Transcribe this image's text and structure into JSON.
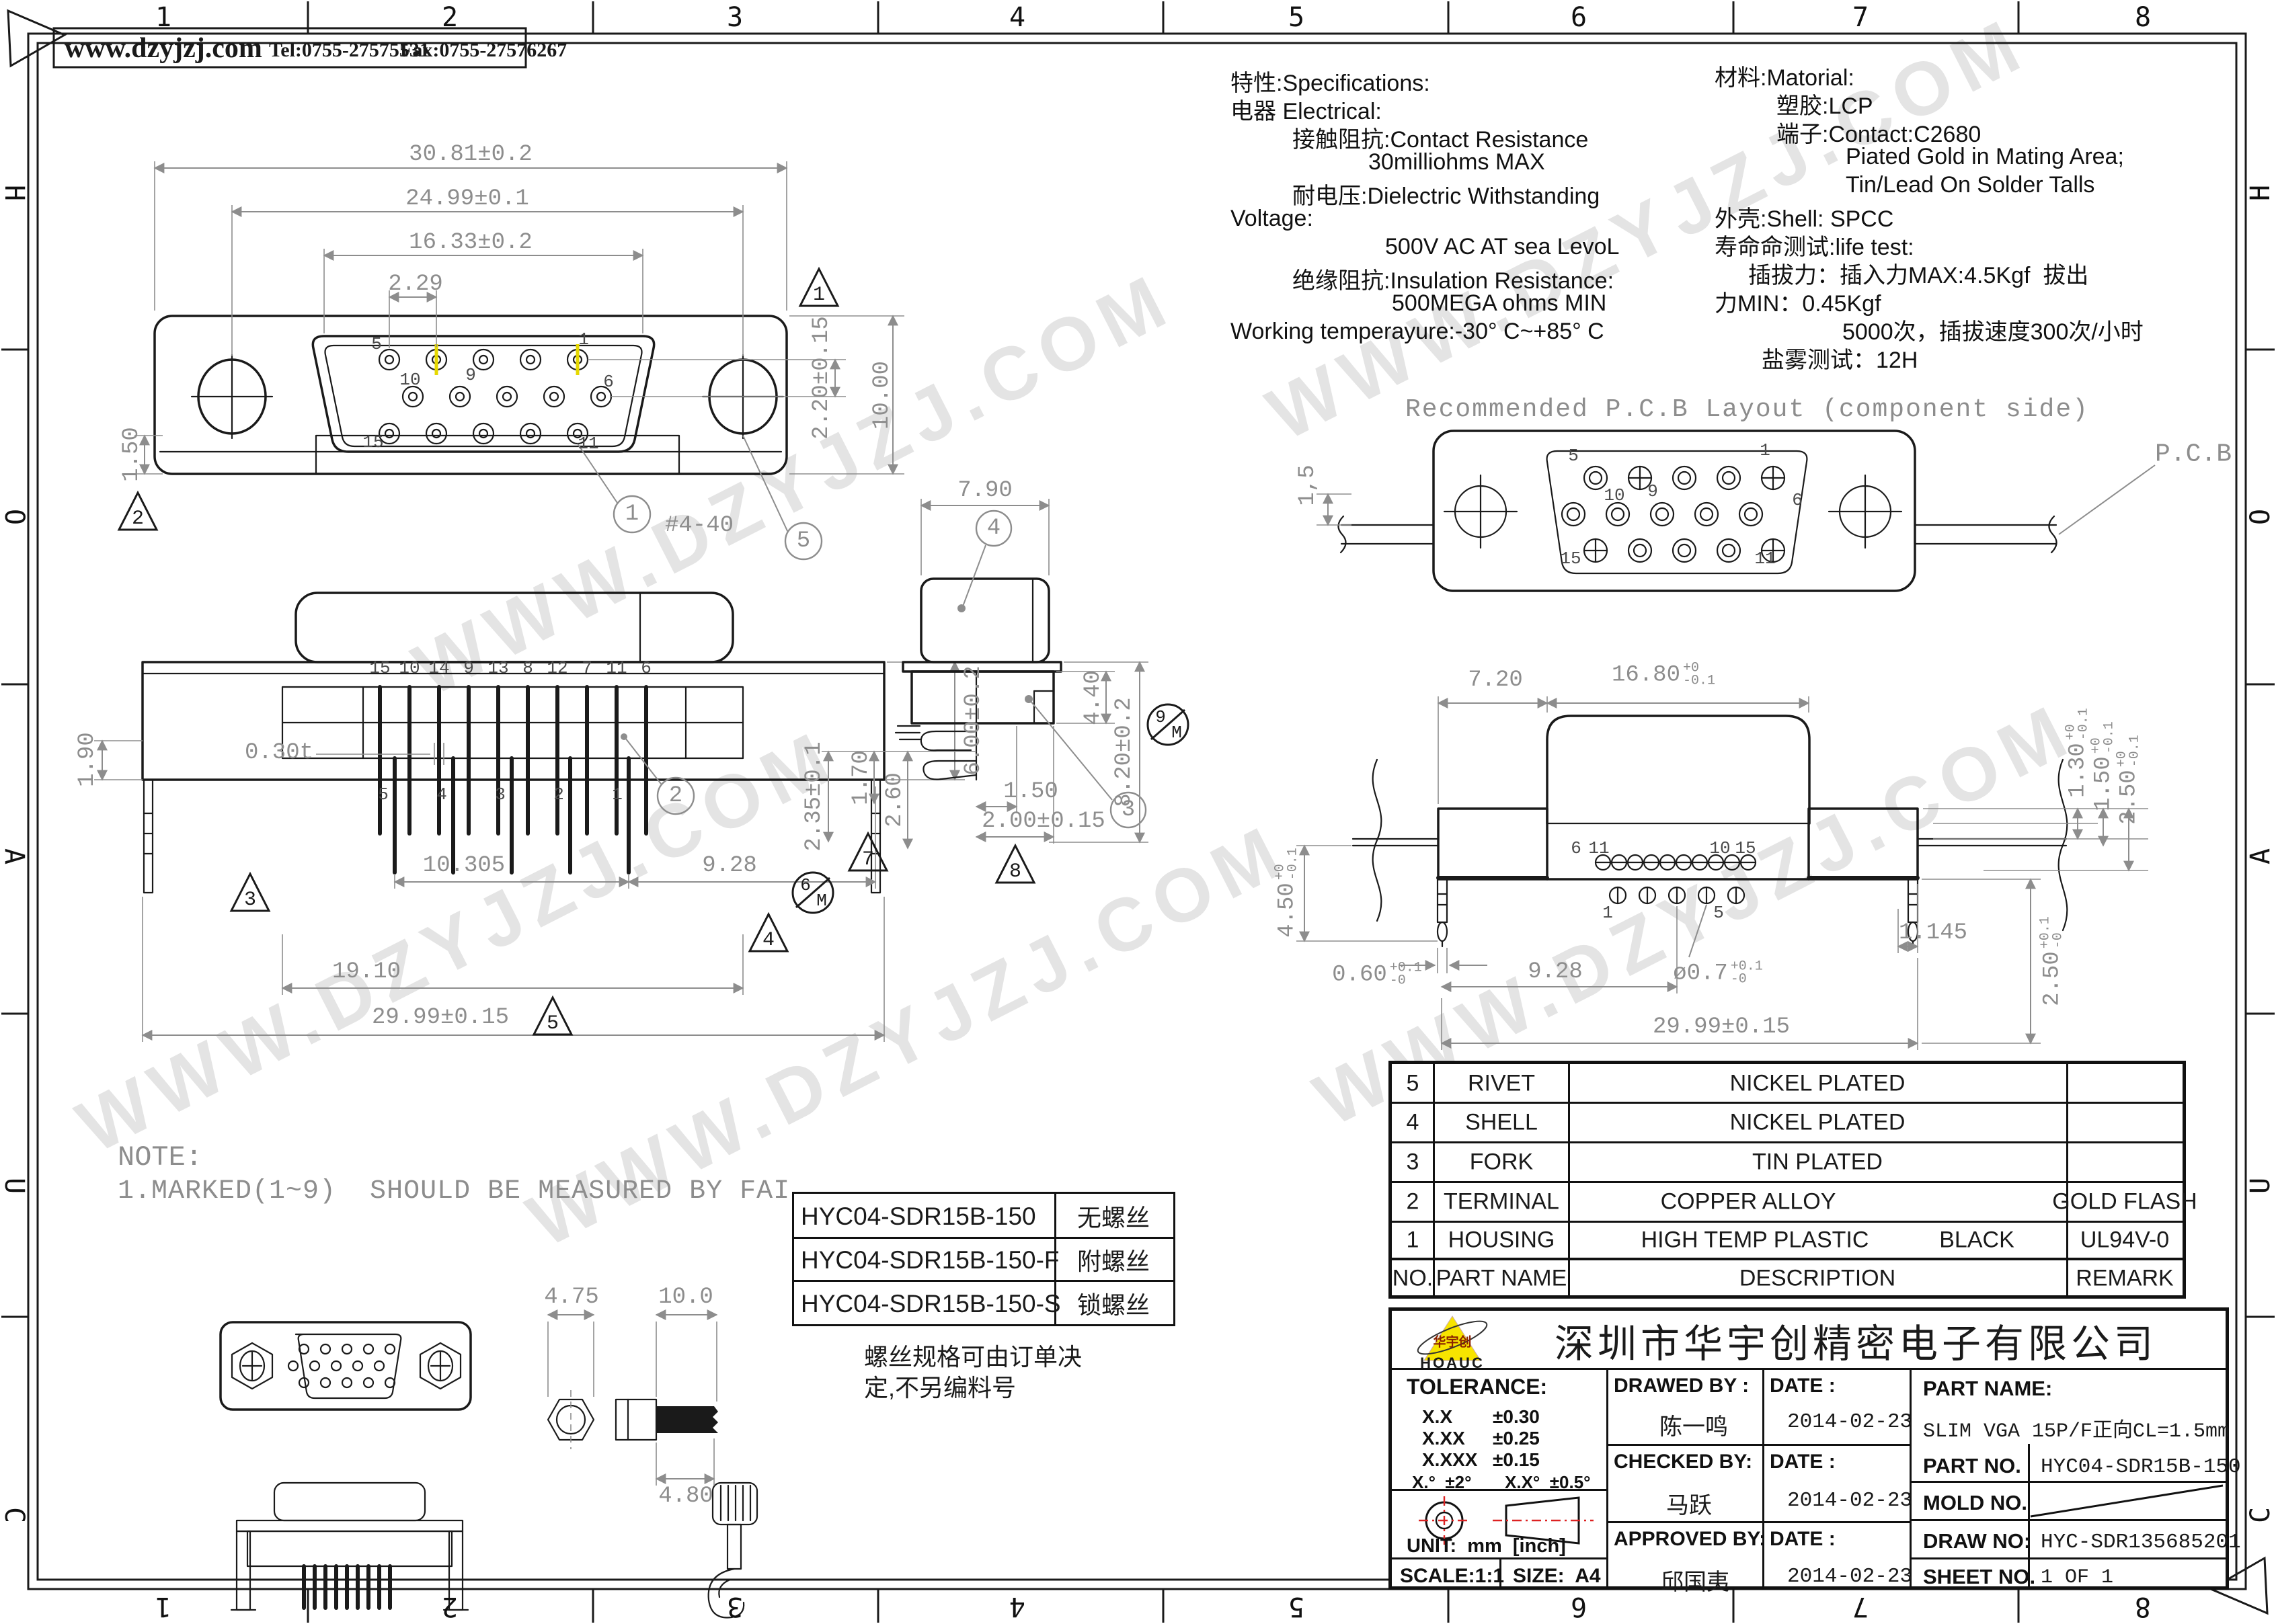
{
  "frame": {
    "cols": [
      "1",
      "2",
      "3",
      "4",
      "5",
      "6",
      "7",
      "8"
    ],
    "rows": [
      "H",
      "O",
      "A",
      "U",
      "C"
    ]
  },
  "header": {
    "website": "www.dzyjzj.com",
    "tel": "Tel:0755-27575531",
    "fax": "Fax:0755-27576267"
  },
  "watermark": "WWW.DZYJZJ.COM",
  "specs": [
    "特性:Specifications:",
    "电器 Electrical:",
    "接触阻抗:Contact Resistance",
    "30milliohms MAX",
    "耐电压:Dielectric Withstanding",
    "Voltage:",
    "500V AC AT sea LevoL",
    "绝缘阻抗:Insulation Resistance:",
    "500MEGA ohms MIN",
    "Working temperayure:-30° C~+85° C"
  ],
  "materials": [
    "材料:Matorial:",
    "塑胶:LCP",
    "端子:Contact:C2680",
    "Piated Gold in Mating Area;",
    "Tin/Lead On Solder Talls",
    "外壳:Shell: SPCC",
    "寿命命测试:life test:",
    "插拔力：插入力MAX:4.5Kgf  拔出",
    "力MIN：0.45Kgf",
    "5000次，插拔速度300次/小时",
    "盐雾测试：12H"
  ],
  "pcbview": {
    "title": "Recommended P.C.B Layout (component side)",
    "pcb": "P.C.B",
    "dim15": "1,5",
    "p5": "5",
    "p1": "1",
    "p10": "10",
    "p9": "9",
    "p6": "6",
    "p15": "15",
    "p11": "11"
  },
  "front": {
    "d1": "30.81±0.2",
    "d2": "24.99±0.1",
    "d3": "16.33±0.2",
    "d4": "2.29",
    "d5": "2.20±0.15",
    "d6": "10.00",
    "d7": "1.50",
    "thread": "#4-40",
    "p5": "5",
    "p1": "1",
    "p10": "10",
    "p9": "9",
    "p6": "6",
    "p15": "15",
    "p11": "11",
    "t1": "1",
    "t2": "2",
    "b1": "1",
    "b5": "5"
  },
  "rear": {
    "d1": "1.90",
    "d2": "6.00±0.2",
    "d3": "0.30t",
    "d4": "10.305",
    "d5": "9.28",
    "d6": "19.10",
    "d7": "29.99±0.15",
    "t3": "3",
    "t4": "4",
    "t5": "5",
    "b2": "2",
    "top": [
      "15",
      "10",
      "14",
      "9",
      "13",
      "8",
      "12",
      "7",
      "11",
      "6"
    ],
    "bot": [
      "5",
      "4",
      "3",
      "2",
      "1"
    ]
  },
  "side": {
    "d1": "7.90",
    "d2": "4.40",
    "d3": "8.20±0.2",
    "d4": "2.35±0.1",
    "d5": "1.70",
    "d6": "2.60",
    "d7": "1.50",
    "d8": "2.00±0.15",
    "b4": "4",
    "b3": "3",
    "t7": "7",
    "t8": "8",
    "b6": "6",
    "b6m": "M",
    "b9": "9",
    "b9m": "M"
  },
  "solder": {
    "d720": "7.20",
    "d1680": {
      "v": "16.80",
      "t": "+0",
      "b": "-0.1"
    },
    "d130": {
      "v": "1.30",
      "t": "+0",
      "b": "-0.1"
    },
    "d150": {
      "v": "1.50",
      "t": "+0",
      "b": "-0.1"
    },
    "d250a": {
      "v": "2.50",
      "t": "+0",
      "b": "-0.1"
    },
    "d450": {
      "v": "4.50",
      "t": "+0",
      "b": "-0.1"
    },
    "d060": {
      "v": "0.60",
      "t": "+0.1",
      "b": "-0"
    },
    "d07": {
      "v": "ø0.7",
      "t": "+0.1",
      "b": "-0"
    },
    "d250b": {
      "v": "2.50",
      "t": "+0.1",
      "b": "-0"
    },
    "d928": "9.28",
    "d1145": "1.145",
    "d2999": "29.99±0.15",
    "p6": "6",
    "p11": "11",
    "p10": "10",
    "p15": "15",
    "p1": "1",
    "p5": "5"
  },
  "note": {
    "title": "NOTE:",
    "line": "1.MARKED(1~9)  SHOULD BE MEASURED BY FAI"
  },
  "screws": {
    "d475": "4.75",
    "d100": "10.0",
    "d480": "4.80"
  },
  "variants": {
    "rows": [
      {
        "pn": "HYC04-SDR15B-150",
        "screw": "无螺丝"
      },
      {
        "pn": "HYC04-SDR15B-150-F",
        "screw": "附螺丝"
      },
      {
        "pn": "HYC04-SDR15B-150-S",
        "screw": "锁螺丝"
      }
    ],
    "note1": "螺丝规格可由订单决",
    "note2": "定,不另编料号"
  },
  "bom": {
    "h": {
      "no": "NO.",
      "part": "PART NAME",
      "desc": "DESCRIPTION",
      "remark": "REMARK"
    },
    "rows": [
      {
        "no": "5",
        "part": "RIVET",
        "desc": "NICKEL PLATED",
        "remark": ""
      },
      {
        "no": "4",
        "part": "SHELL",
        "desc": "NICKEL PLATED",
        "remark": ""
      },
      {
        "no": "3",
        "part": "FORK",
        "desc": "TIN PLATED",
        "remark": ""
      },
      {
        "no": "2",
        "part": "TERMINAL",
        "desc": "COPPER ALLOY",
        "remark": "GOLD FLASH"
      },
      {
        "no": "1",
        "part": "HOUSING",
        "desc": "HIGH TEMP PLASTIC",
        "desc2": "BLACK",
        "remark": "UL94V-0"
      }
    ]
  },
  "tb": {
    "company": "深圳市华宇创精密电子有限公司",
    "logo": "HOAUC",
    "logo_cn": "华宇创",
    "tol_title": "TOLERANCE:",
    "t1l": "X.X",
    "t1v": "±0.30",
    "t2l": "X.XX",
    "t2v": "±0.25",
    "t3l": "X.XXX",
    "t3v": "±0.15",
    "ta1": "X.°  ±2°",
    "ta2": "X.X°  ±0.5°",
    "unit": "UNIT:  mm  [inch]",
    "scale": "SCALE:1:1",
    "size": "SIZE:  A4",
    "drawed": "DRAWED BY :",
    "drawed_name": "陈一鸣",
    "date": "DATE :",
    "date1": "2014-02-23",
    "checked": "CHECKED BY:",
    "checked_name": "马跃",
    "date2": "2014-02-23",
    "approved": "APPROVED BY:",
    "approved_name": "邱国夷",
    "date3": "2014-02-23",
    "pn_label": "PART NAME:",
    "pn": "SLIM VGA 15P/F正向CL=1.5mm",
    "pno_label": "PART NO.",
    "pno": "HYC04-SDR15B-150",
    "mold_label": "MOLD NO.",
    "draw_label": "DRAW NO:",
    "draw_no": "HYC-SDR135685201",
    "sheet_label": "SHEET NO.",
    "sheet": "1 OF 1"
  }
}
